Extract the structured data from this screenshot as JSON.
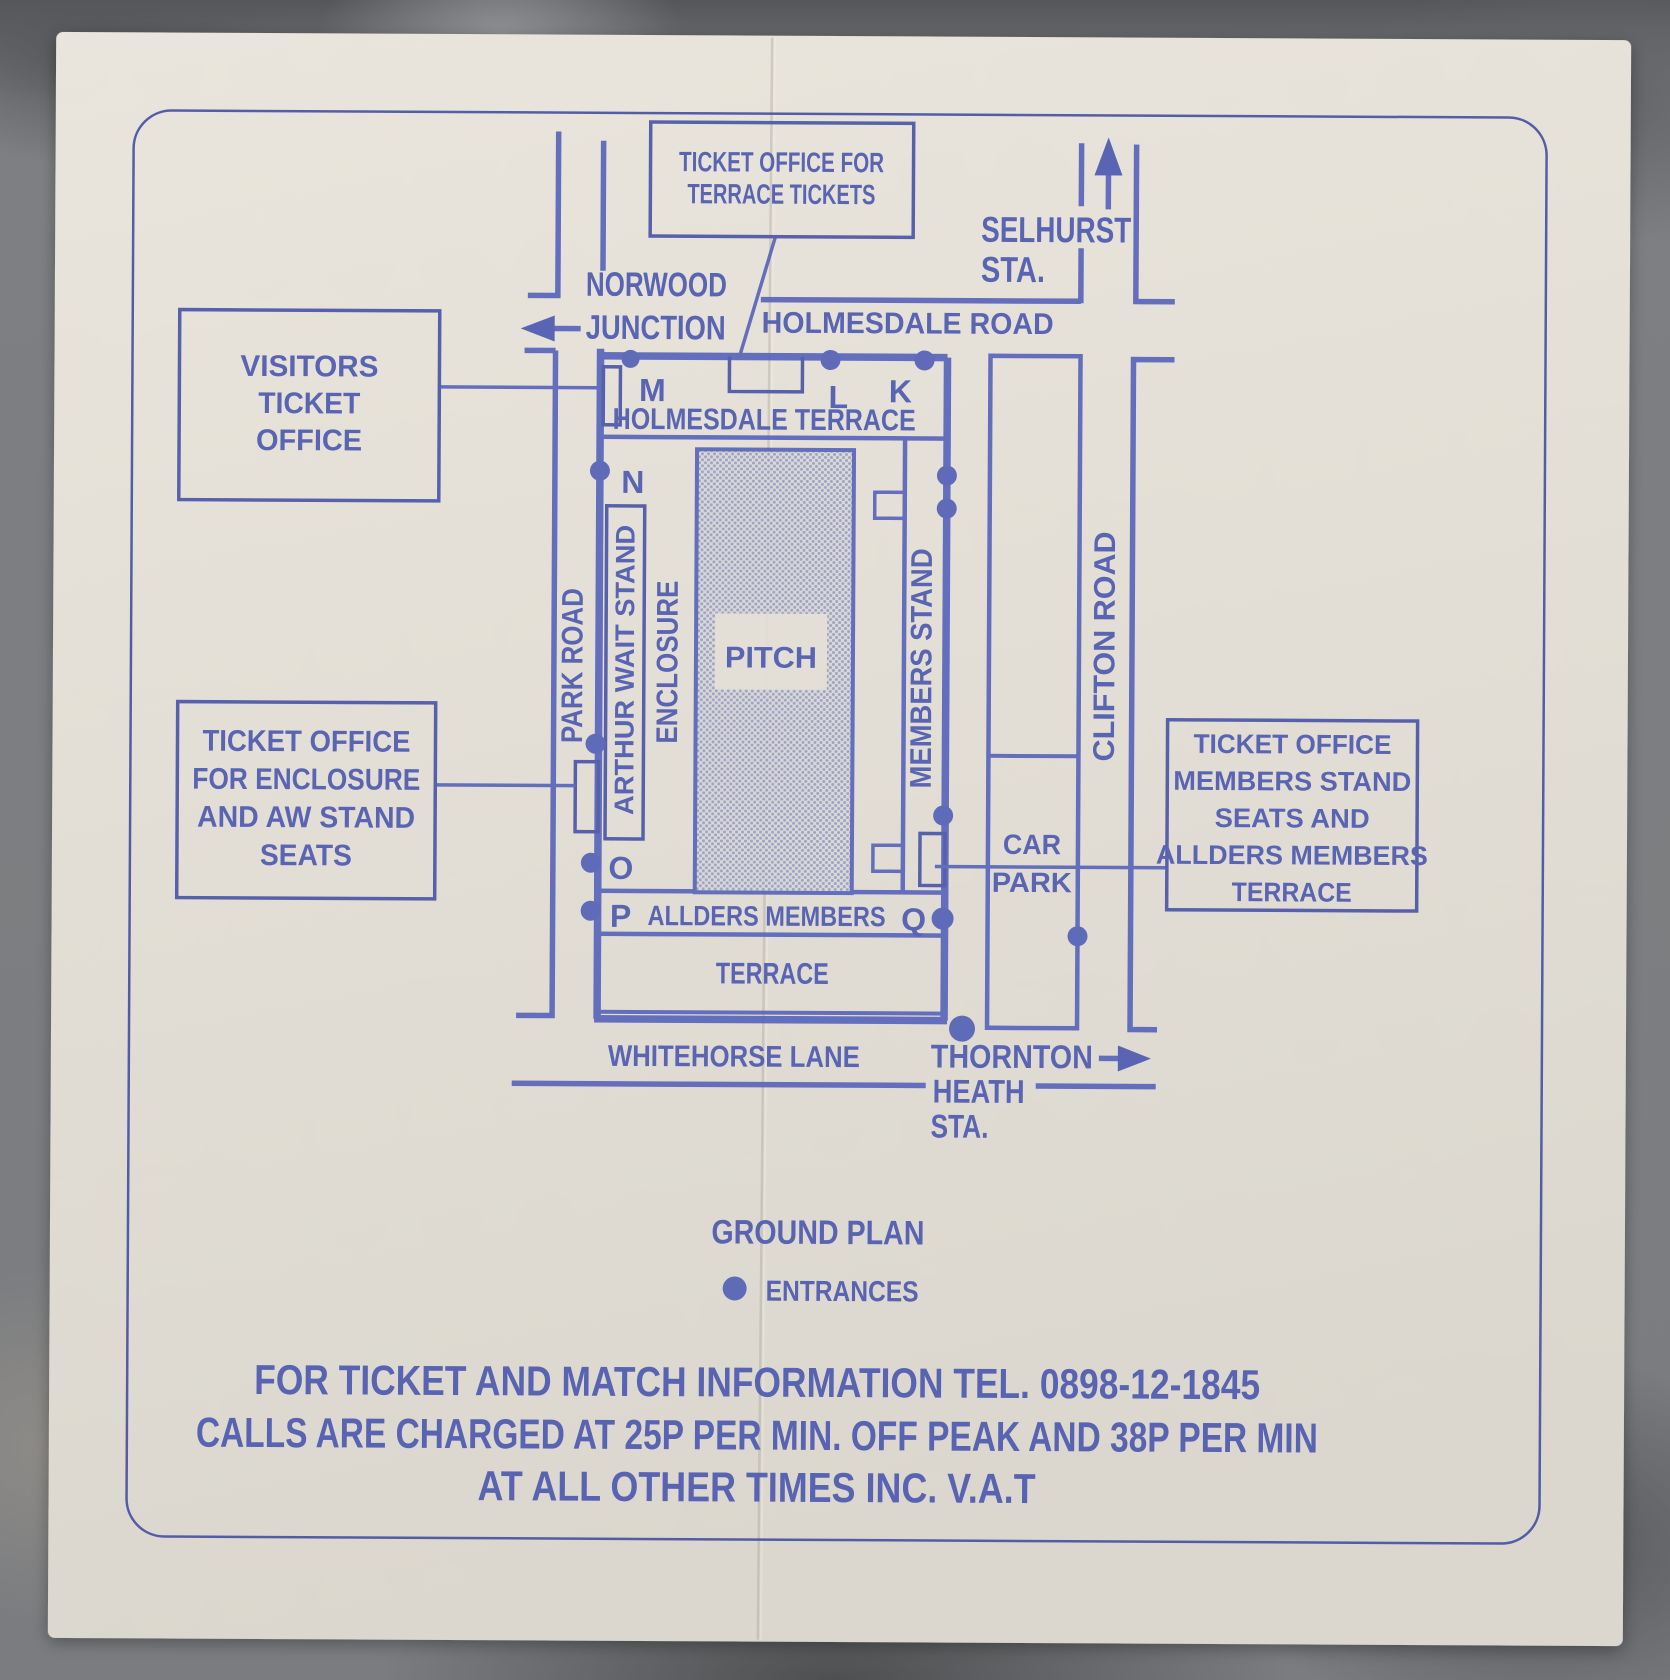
{
  "colors": {
    "ink": "#4f5bb0",
    "line_blue": "#5a66bb",
    "paper": "#e3dfd6",
    "halftone_dot": "#95a0cf",
    "stone_background": "#7a7c7f",
    "border_blue": "#4853a3"
  },
  "header_box": {
    "line1": "TICKET OFFICE FOR",
    "line2": "TERRACE TICKETS"
  },
  "stations": {
    "selhurst": {
      "line1": "SELHURST",
      "line2": "STA."
    },
    "norwood": {
      "line1": "NORWOOD",
      "line2": "JUNCTION"
    },
    "thornton": {
      "line1": "THORNTON",
      "line2": "HEATH",
      "line3": "STA."
    }
  },
  "roads": {
    "holmesdale": "HOLMESDALE ROAD",
    "park": "PARK ROAD",
    "clifton": "CLIFTON ROAD",
    "whitehorse": "WHITEHORSE LANE"
  },
  "stadium": {
    "holmesdale_terrace": "HOLMESDALE TERRACE",
    "arthur_wait": "ARTHUR WAIT STAND",
    "enclosure": "ENCLOSURE",
    "pitch": "PITCH",
    "members_stand": "MEMBERS STAND",
    "allders": "ALLDERS MEMBERS",
    "terrace": "TERRACE",
    "car_park": {
      "line1": "CAR",
      "line2": "PARK"
    },
    "gates": {
      "m": "M",
      "l": "L",
      "k": "K",
      "n": "N",
      "o": "O",
      "p": "P",
      "q": "Q"
    }
  },
  "offices": {
    "visitors": {
      "lines": [
        "VISITORS",
        "TICKET",
        "OFFICE"
      ]
    },
    "enclosure_aw": {
      "lines": [
        "TICKET OFFICE",
        "FOR ENCLOSURE",
        "AND AW STAND",
        "SEATS"
      ]
    },
    "members": {
      "lines": [
        "TICKET OFFICE",
        "MEMBERS STAND",
        "SEATS AND",
        "ALLDERS MEMBERS",
        "TERRACE"
      ]
    }
  },
  "legend": {
    "title": "GROUND PLAN",
    "entrances": "ENTRANCES"
  },
  "footer": {
    "line1": "FOR TICKET AND MATCH INFORMATION TEL. 0898-12-1845",
    "line2": "CALLS ARE CHARGED AT 25P PER MIN. OFF PEAK AND 38P PER MIN",
    "line3": "AT ALL OTHER TIMES INC. V.A.T"
  }
}
